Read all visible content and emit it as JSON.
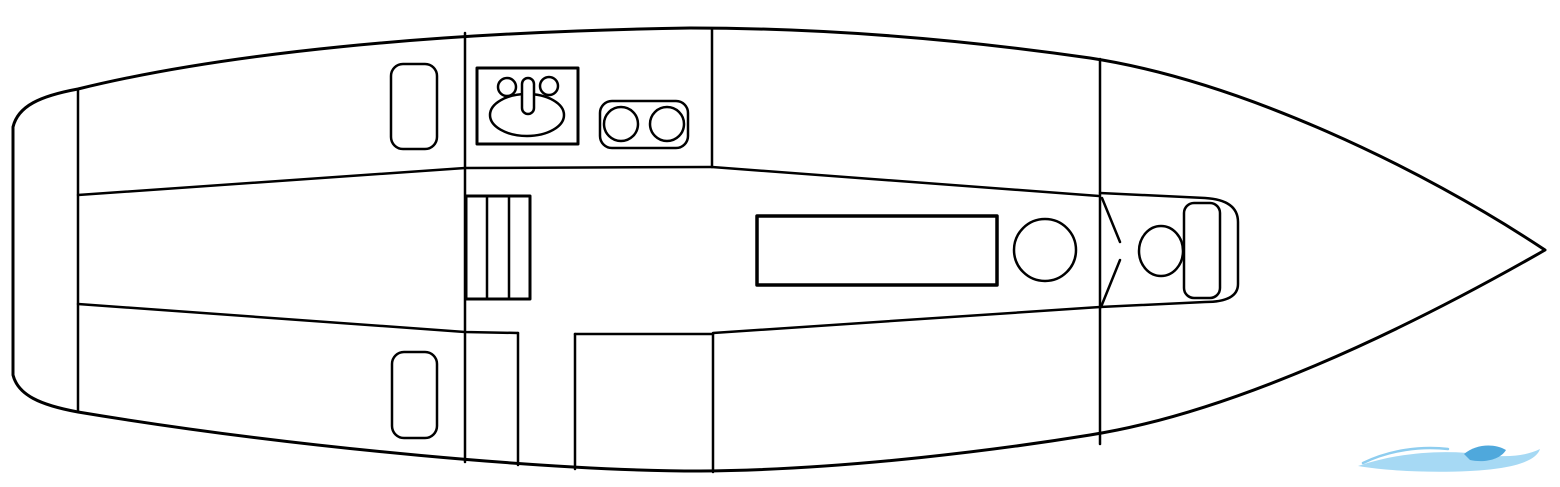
{
  "diagram": {
    "name": "sailboat-interior-floor-plan",
    "canvas": {
      "width": 1560,
      "height": 487,
      "background": "#ffffff",
      "line_color": "#000000",
      "default_stroke_width": 2.5
    },
    "watermark_colors": {
      "arc": "#8ecdef",
      "swoosh": "#a6d9f4",
      "crest": "#4fa8dc"
    },
    "elements": [
      {
        "name": "hull-outline",
        "shape": "path",
        "d": "M 13 127 C 18 106 40 96 78 89 C 220 54 430 32 690 28 C 830 28 965 40 1090 58 C 1240 81 1420 167 1545 250 C 1400 333 1230 413 1090 435 C 1010 448 850 470 700 471 C 560 471 300 449 78 412 C 40 405 18 395 13 375 Z",
        "stroke_width": 3,
        "fill": "#ffffff"
      },
      {
        "name": "transom-bulkhead-line",
        "shape": "line",
        "x1": 78,
        "y1": 89,
        "x2": 78,
        "y2": 411
      },
      {
        "name": "main-bulkhead-line",
        "shape": "line",
        "x1": 465,
        "y1": 33,
        "x2": 465,
        "y2": 462
      },
      {
        "name": "cockpit-seat-top-edge",
        "shape": "path",
        "d": "M 78 195 L 465 168 L 712 167"
      },
      {
        "name": "cockpit-seat-bottom-edge",
        "shape": "path",
        "d": "M 78 304 L 465 332 L 518 333"
      },
      {
        "name": "galley-partition-line",
        "shape": "line",
        "x1": 712,
        "y1": 29,
        "x2": 712,
        "y2": 167
      },
      {
        "name": "starboard-settee-edge",
        "shape": "line",
        "x1": 712,
        "y1": 167,
        "x2": 1099,
        "y2": 196
      },
      {
        "name": "port-settee-edge",
        "shape": "line",
        "x1": 713,
        "y1": 333,
        "x2": 1100,
        "y2": 307
      },
      {
        "name": "quarter-berth-aft-line",
        "shape": "line",
        "x1": 518,
        "y1": 333,
        "x2": 518,
        "y2": 465
      },
      {
        "name": "quarter-berth-top-edge",
        "shape": "line",
        "x1": 575,
        "y1": 334,
        "x2": 713,
        "y2": 334
      },
      {
        "name": "quarter-berth-fwd-line",
        "shape": "line",
        "x1": 575,
        "y1": 334,
        "x2": 575,
        "y2": 469
      },
      {
        "name": "quarter-berth-corner-line",
        "shape": "line",
        "x1": 713,
        "y1": 334,
        "x2": 713,
        "y2": 472
      },
      {
        "name": "forward-bulkhead-line",
        "shape": "line",
        "x1": 1100,
        "y1": 59,
        "x2": 1100,
        "y2": 444
      },
      {
        "name": "cockpit-hatch-starboard",
        "shape": "rect",
        "x": 391,
        "y": 64,
        "w": 46,
        "h": 85,
        "rx": 12
      },
      {
        "name": "cockpit-hatch-port",
        "shape": "rect",
        "x": 392,
        "y": 352,
        "w": 45,
        "h": 86,
        "rx": 12
      },
      {
        "name": "galley-sink-counter",
        "shape": "rect",
        "x": 477,
        "y": 68,
        "w": 101,
        "h": 76,
        "stroke_width": 3
      },
      {
        "name": "sink-basin",
        "shape": "ellipse",
        "cx": 527,
        "cy": 115,
        "rx": 37,
        "ry": 21
      },
      {
        "name": "sink-faucet",
        "shape": "rect",
        "x": 522,
        "y": 78,
        "w": 12,
        "h": 36,
        "rx": 6,
        "fill": "#ffffff"
      },
      {
        "name": "sink-tap-left",
        "shape": "circle",
        "cx": 507,
        "cy": 87,
        "r": 9
      },
      {
        "name": "sink-tap-right",
        "shape": "circle",
        "cx": 549,
        "cy": 86,
        "r": 9
      },
      {
        "name": "stove-top",
        "shape": "rect",
        "x": 600,
        "y": 101,
        "w": 88,
        "h": 47,
        "rx": 12
      },
      {
        "name": "stove-burner-left",
        "shape": "circle",
        "cx": 621,
        "cy": 124,
        "r": 17
      },
      {
        "name": "stove-burner-right",
        "shape": "circle",
        "cx": 667,
        "cy": 124,
        "r": 17
      },
      {
        "name": "companionway-steps",
        "shape": "rect",
        "x": 466,
        "y": 196,
        "w": 64,
        "h": 103,
        "stroke_width": 3
      },
      {
        "name": "companionway-step-line-1",
        "shape": "line",
        "x1": 487,
        "y1": 196,
        "x2": 487,
        "y2": 299
      },
      {
        "name": "companionway-step-line-2",
        "shape": "line",
        "x1": 509,
        "y1": 196,
        "x2": 509,
        "y2": 299
      },
      {
        "name": "saloon-table",
        "shape": "rect",
        "x": 757,
        "y": 216,
        "w": 240,
        "h": 69,
        "stroke_width": 3.5
      },
      {
        "name": "mast-ring",
        "shape": "circle",
        "cx": 1045,
        "cy": 250,
        "r": 31
      },
      {
        "name": "head-door-leaf-upper",
        "shape": "line",
        "x1": 1102,
        "y1": 198,
        "x2": 1120,
        "y2": 242
      },
      {
        "name": "head-door-leaf-lower",
        "shape": "line",
        "x1": 1120,
        "y1": 260,
        "x2": 1101,
        "y2": 307
      },
      {
        "name": "head-compartment",
        "shape": "path",
        "d": "M 1100 193 L 1205 198 Q 1238 200 1238 222 L 1238 284 Q 1238 302 1205 302 L 1100 307"
      },
      {
        "name": "toilet-bowl",
        "shape": "ellipse",
        "cx": 1161,
        "cy": 251,
        "rx": 22,
        "ry": 25
      },
      {
        "name": "toilet-tank",
        "shape": "rect",
        "x": 1184,
        "y": 203,
        "w": 36,
        "h": 95,
        "rx": 10,
        "fill": "#ffffff"
      },
      {
        "name": "watermark-wave-arc",
        "shape": "path",
        "d": "M 1363 463 C 1390 450 1420 446 1448 449",
        "stroke": "#8ecdef",
        "stroke_width": 2.5
      },
      {
        "name": "watermark-wave-swoosh",
        "shape": "path",
        "d": "M 1358 466 C 1400 452 1445 449 1487 455 C 1510 458 1528 455 1540 449 C 1536 462 1510 469 1470 471 C 1430 473 1388 471 1358 466 Z",
        "fill": "#a6d9f4",
        "stroke": "none"
      },
      {
        "name": "watermark-wave-crest",
        "shape": "path",
        "d": "M 1464 454 C 1476 444 1494 443 1506 450 C 1500 460 1484 463 1470 460 C 1468 458 1466 456 1464 454 Z",
        "fill": "#4fa8dc",
        "stroke": "none"
      }
    ]
  }
}
